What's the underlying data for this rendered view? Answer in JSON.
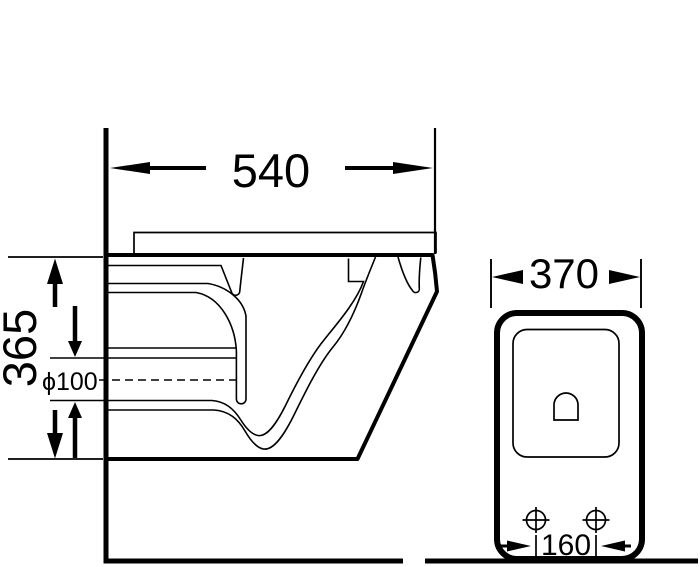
{
  "drawing_title": "wall-hung toilet installation dimension drawing",
  "labels": {
    "side_depth": "540",
    "side_height": "365",
    "outlet_diameter": "ϕ100",
    "front_width": "370",
    "bolt_spacing": "160"
  },
  "colors": {
    "line": "#000000",
    "background": "#ffffff"
  }
}
